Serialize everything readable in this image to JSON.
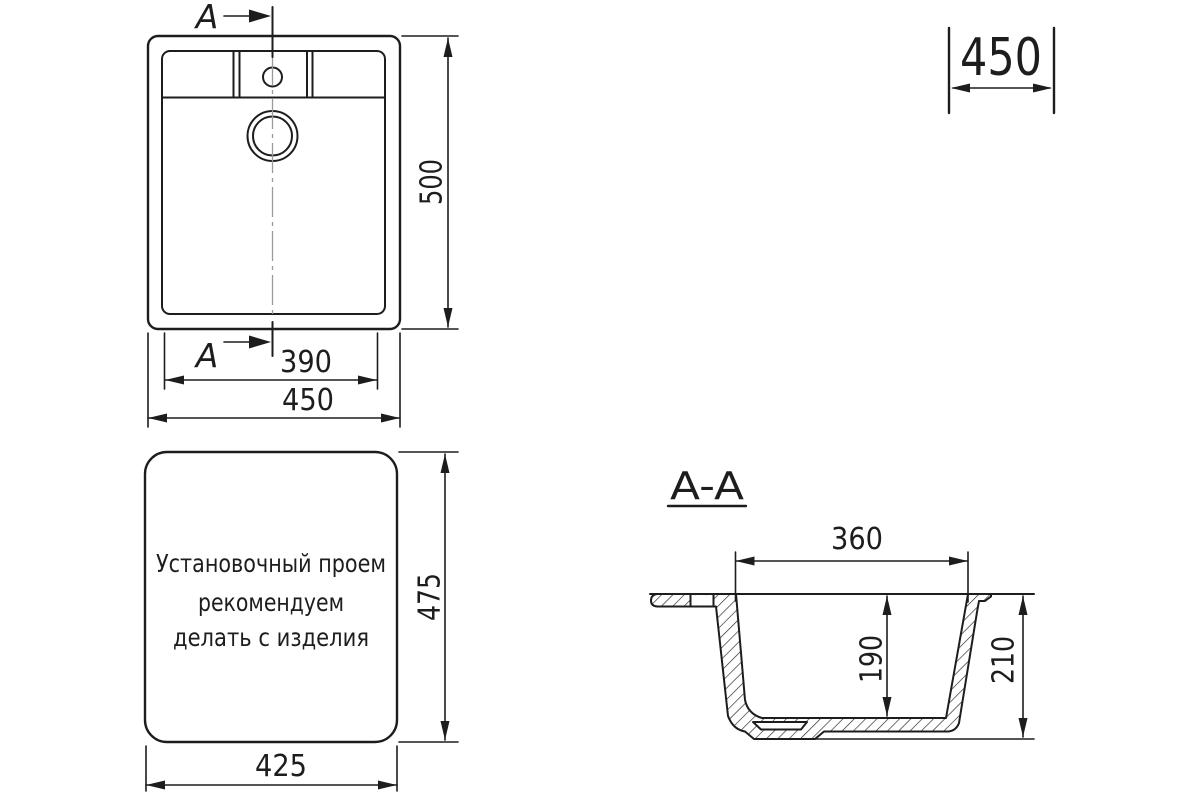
{
  "meta": {
    "background_color": "#ffffff",
    "line_color": "#1d1d1d",
    "centerline_color": "#9a9a9a"
  },
  "top_view": {
    "section_label_top": "A",
    "section_label_bottom": "A",
    "dim_bowl_width": "390",
    "dim_overall_width": "450",
    "dim_overall_length": "500"
  },
  "front_width_dim": "450",
  "cutout_view": {
    "note_lines": [
      "Установочный проем",
      "рекомендуем",
      "делать с изделия"
    ],
    "dim_width": "425",
    "dim_height": "475"
  },
  "section_view": {
    "title": "A-A",
    "dim_bowl_top_width": "360",
    "dim_bowl_depth": "190",
    "dim_overall_depth": "210"
  }
}
